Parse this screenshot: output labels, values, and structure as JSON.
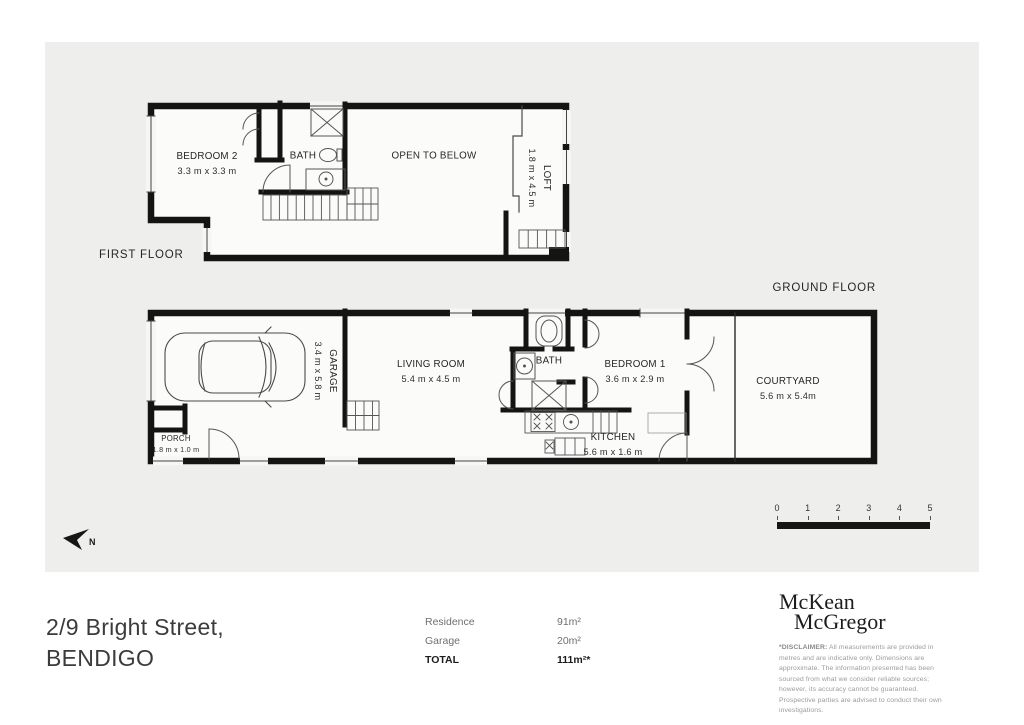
{
  "first_floor": {
    "title": "FIRST FLOOR",
    "bedroom2_name": "BEDROOM 2",
    "bedroom2_dims": "3.3 m x 3.3 m",
    "bath_name": "BATH",
    "open_name": "OPEN TO BELOW",
    "loft_name": "LOFT",
    "loft_dims": "1.8 m x 4.5 m"
  },
  "ground_floor": {
    "title": "GROUND FLOOR",
    "garage_name": "GARAGE",
    "garage_dims": "3.4 m x 5.8 m",
    "living_name": "LIVING ROOM",
    "living_dims": "5.4 m x 4.5 m",
    "porch_name": "PORCH",
    "porch_dims": "1.8 m x 1.0 m",
    "bath_name": "BATH",
    "bedroom1_name": "BEDROOM 1",
    "bedroom1_dims": "3.6 m x 2.9 m",
    "kitchen_name": "KITCHEN",
    "kitchen_dims": "5.6 m x 1.6 m",
    "courtyard_name": "COURTYARD",
    "courtyard_dims": "5.6 m x 5.4m"
  },
  "compass": {
    "north_label": "N"
  },
  "scale_bar": {
    "ticks": [
      "0",
      "1",
      "2",
      "3",
      "4",
      "5"
    ]
  },
  "footer": {
    "address_line1": "2/9 Bright Street,",
    "address_line2": "BENDIGO",
    "areas": {
      "rows": [
        {
          "label": "Residence",
          "value": "91m²"
        },
        {
          "label": "Garage",
          "value": "20m²"
        },
        {
          "label": "TOTAL",
          "value": "111m²*"
        }
      ]
    },
    "logo": {
      "line1": "McKean",
      "line2": "McGregor"
    },
    "disclaimer_label": "*DISCLAIMER:",
    "disclaimer_text": " All measurements are provided in metres and are indicative only. Dimensions are approximate. The information presented has been sourced from what we consider reliable sources; however, its accuracy cannot be guaranteed. Prospective parties are advised to conduct their own investigations."
  },
  "colors": {
    "wall": "#141414",
    "panel": "#eeeeec",
    "floor": "#fbfbfa",
    "text": "#2b2b2b"
  }
}
